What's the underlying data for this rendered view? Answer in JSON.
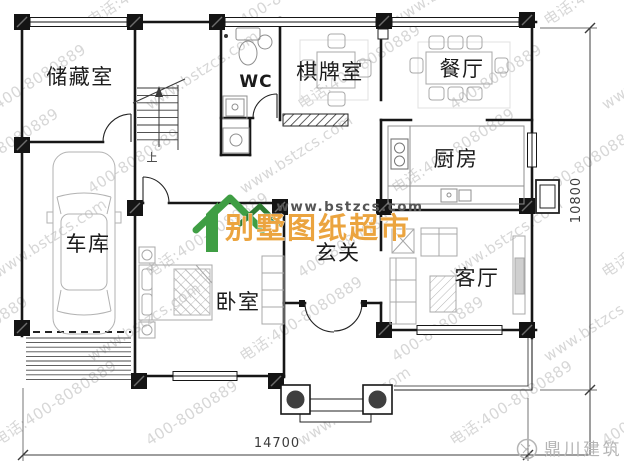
{
  "page": {
    "background": "#ffffff"
  },
  "plan": {
    "rooms": [
      {
        "id": "storage",
        "label": "储藏室"
      },
      {
        "id": "wc",
        "label": "WC"
      },
      {
        "id": "chess-room",
        "label": "棋牌室"
      },
      {
        "id": "dining-room",
        "label": "餐厅"
      },
      {
        "id": "kitchen",
        "label": "厨房"
      },
      {
        "id": "garage",
        "label": "车库"
      },
      {
        "id": "bedroom",
        "label": "卧室"
      },
      {
        "id": "foyer",
        "label": "玄关"
      },
      {
        "id": "living-room",
        "label": "客厅"
      }
    ],
    "stair_up": "上",
    "dimensions": {
      "bottom_width": "14700",
      "right_height": "10800"
    }
  },
  "watermark": {
    "site": "www.bstzcs.com",
    "phone": "400-8080889",
    "phone_with_prefix": "电话:400-8080889",
    "color": "#d7d7d7"
  },
  "brand": {
    "site_label": "www.bstzcs.com",
    "name": "别墅图纸超市",
    "name_color": "#eba43f",
    "icon_green": "#3f9e44",
    "icon_green_dark": "#2f7d33"
  },
  "footer_logo": {
    "name": "鼎川建筑",
    "color": "#b5b5b5"
  }
}
